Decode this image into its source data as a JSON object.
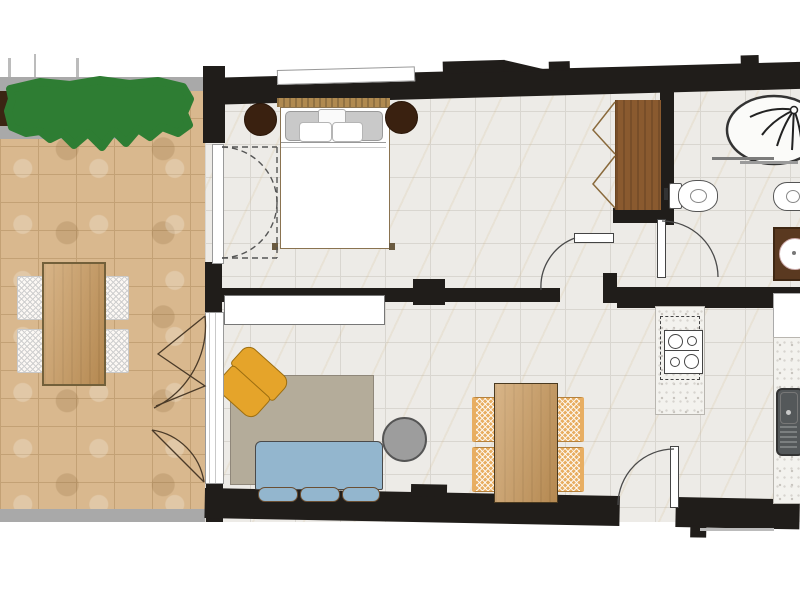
{
  "document": {
    "type": "floor-plan",
    "view": "top-down-2d-apartment-plan",
    "visible_text": ""
  },
  "colors": {
    "wall": "#201d1a",
    "interior-floor": "#edebe7",
    "terrace-tile": "#d9b88e",
    "terrace-curb": "#a9a9a9",
    "hedge-green": "#2e7d33",
    "planter-soil": "#3b2513",
    "wood-light": "#c9985a",
    "wood-mid": "#b08a50",
    "wood-dark": "#8a5a2f",
    "wood-darkest": "#3a2110",
    "sofa-blue": "#93b6ce",
    "armchair-yellow": "#e5a42a",
    "rug-taupe": "#b4ac9a",
    "rattan-orange": "#e8ae62",
    "table-metal-gray": "#9d9d9d",
    "sink-gray": "#54585a",
    "washer-brown": "#5a3920"
  },
  "floor_plan": {
    "rooms": [
      {
        "id": "terrace",
        "features": [
          "hedge-planter",
          "curb-walls",
          "outdoor-dining-table",
          "four-outdoor-chairs"
        ]
      },
      {
        "id": "bedroom",
        "features": [
          "double-bed",
          "wooden-headboard",
          "two-round-bedside-stools",
          "wardrobe-with-folding-doors",
          "french-door-to-terrace",
          "window-in-wall"
        ]
      },
      {
        "id": "living-room",
        "features": [
          "sideboard",
          "rug",
          "armchair",
          "three-seat-sofa",
          "round-coffee-table",
          "dining-table",
          "four-dining-chairs",
          "bifold-glass-door-to-terrace"
        ]
      },
      {
        "id": "kitchen",
        "features": [
          "peninsula-counter",
          "four-burner-cooktop",
          "side-counter",
          "sink-with-drainboard"
        ]
      },
      {
        "id": "bathroom",
        "features": [
          "walk-in-shower",
          "glass-screen",
          "toilet",
          "bidet",
          "washing-machine"
        ]
      },
      {
        "id": "hallway",
        "features": [
          "bedroom-door",
          "bathroom-door",
          "entrance-door"
        ]
      }
    ],
    "doors": [
      {
        "id": "entrance-door",
        "swing": "quarter-arc"
      },
      {
        "id": "bedroom-door",
        "swing": "quarter-arc"
      },
      {
        "id": "bathroom-door",
        "swing": "quarter-arc"
      },
      {
        "id": "bedroom-french-door",
        "swing": "double-dashed-arc"
      },
      {
        "id": "living-room-bifold-door",
        "swing": "folding-arcs"
      }
    ]
  }
}
